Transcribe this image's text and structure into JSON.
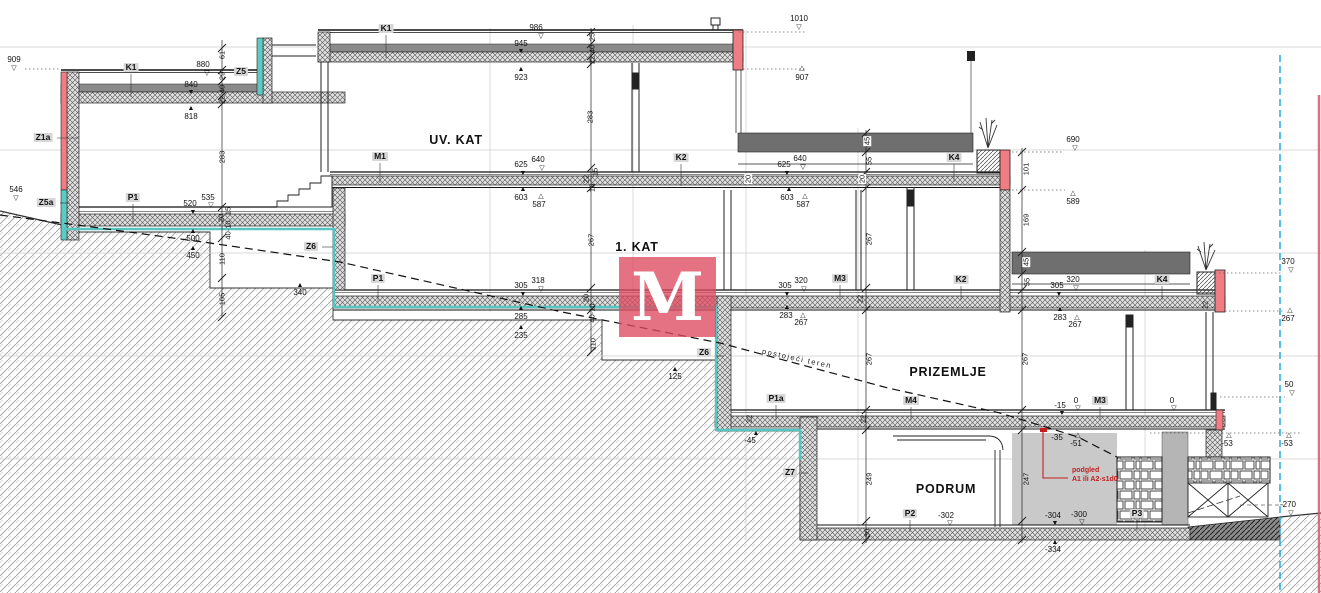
{
  "drawing": {
    "type": "building cross-section",
    "floor_names": [
      "UV. KAT",
      "1. KAT",
      "PRIZEMLJE",
      "PODRUM"
    ],
    "terrain_line_label": "postojeći teren",
    "note": {
      "line1": "podgled",
      "line2": "A1 ili A2-s1d0"
    },
    "colors": {
      "wall_accent_red": "#e2506a",
      "waterproofing_teal": "#56c4c0",
      "boundary_blue": "#2aa8dc",
      "deck_gray": "#6f6f6f",
      "watermark_red": "rgba(222,74,95,0.78)"
    }
  },
  "watermark": {
    "letter": "M"
  },
  "annotations": [
    {
      "t": "909",
      "x": 14,
      "y": 56,
      "c": "e",
      "n": "elev-909"
    },
    {
      "t": "▽",
      "x": 14,
      "y": 65,
      "c": "tri",
      "n": "marker-909"
    },
    {
      "t": "546",
      "x": 16,
      "y": 186,
      "c": "e",
      "n": "elev-546"
    },
    {
      "t": "▽",
      "x": 16,
      "y": 195,
      "c": "tri",
      "n": "marker-546"
    },
    {
      "t": "880",
      "x": 203,
      "y": 61,
      "c": "e",
      "n": "elev-880"
    },
    {
      "t": "▽",
      "x": 207,
      "y": 70,
      "c": "tri",
      "n": "marker-880"
    },
    {
      "t": "840",
      "x": 191,
      "y": 81,
      "c": "e",
      "n": "elev-840"
    },
    {
      "t": "▼",
      "x": 191,
      "y": 89,
      "c": "tri",
      "n": "marker-840"
    },
    {
      "t": "818",
      "x": 191,
      "y": 113,
      "c": "e",
      "n": "elev-818"
    },
    {
      "t": "▲",
      "x": 191,
      "y": 105,
      "c": "tri",
      "n": "marker-818"
    },
    {
      "t": "986",
      "x": 536,
      "y": 24,
      "c": "e",
      "n": "elev-986"
    },
    {
      "t": "▽",
      "x": 541,
      "y": 33,
      "c": "tri",
      "n": "marker-986"
    },
    {
      "t": "945",
      "x": 521,
      "y": 40,
      "c": "e",
      "n": "elev-945"
    },
    {
      "t": "▼",
      "x": 521,
      "y": 48,
      "c": "tri",
      "n": "marker-945"
    },
    {
      "t": "923",
      "x": 521,
      "y": 74,
      "c": "e",
      "n": "elev-923"
    },
    {
      "t": "▲",
      "x": 521,
      "y": 66,
      "c": "tri",
      "n": "marker-923"
    },
    {
      "t": "1010",
      "x": 799,
      "y": 15,
      "c": "e",
      "n": "elev-1010"
    },
    {
      "t": "▽",
      "x": 799,
      "y": 24,
      "c": "tri",
      "n": "marker-1010"
    },
    {
      "t": "907",
      "x": 802,
      "y": 74,
      "c": "e",
      "n": "elev-907"
    },
    {
      "t": "△",
      "x": 802,
      "y": 65,
      "c": "tri",
      "n": "marker-907"
    },
    {
      "t": "535",
      "x": 208,
      "y": 194,
      "c": "e",
      "n": "elev-535"
    },
    {
      "t": "▽",
      "x": 211,
      "y": 202,
      "c": "tri",
      "n": "marker-535"
    },
    {
      "t": "520",
      "x": 190,
      "y": 200,
      "c": "e",
      "n": "elev-520"
    },
    {
      "t": "▼",
      "x": 193,
      "y": 209,
      "c": "tri",
      "n": "marker-520"
    },
    {
      "t": "500",
      "x": 193,
      "y": 235,
      "c": "e",
      "n": "elev-500"
    },
    {
      "t": "▲",
      "x": 193,
      "y": 228,
      "c": "tri",
      "n": "marker-500"
    },
    {
      "t": "450",
      "x": 193,
      "y": 252,
      "c": "e",
      "n": "elev-450"
    },
    {
      "t": "▲",
      "x": 193,
      "y": 245,
      "c": "tri",
      "n": "marker-450"
    },
    {
      "t": "340",
      "x": 300,
      "y": 289,
      "c": "e",
      "n": "elev-340"
    },
    {
      "t": "▲",
      "x": 300,
      "y": 282,
      "c": "tri",
      "n": "marker-340"
    },
    {
      "t": "640",
      "x": 538,
      "y": 156,
      "c": "e",
      "n": "elev-640-m1"
    },
    {
      "t": "▽",
      "x": 542,
      "y": 165,
      "c": "tri",
      "n": "marker-640-m1"
    },
    {
      "t": "625",
      "x": 521,
      "y": 161,
      "c": "e",
      "n": "elev-625-m1"
    },
    {
      "t": "▼",
      "x": 523,
      "y": 170,
      "c": "tri",
      "n": "marker-625-m1"
    },
    {
      "t": "603",
      "x": 521,
      "y": 194,
      "c": "e",
      "n": "elev-603-m1"
    },
    {
      "t": "▲",
      "x": 523,
      "y": 186,
      "c": "tri",
      "n": "marker-603-m1"
    },
    {
      "t": "587",
      "x": 539,
      "y": 201,
      "c": "e",
      "n": "elev-587-m1"
    },
    {
      "t": "△",
      "x": 541,
      "y": 193,
      "c": "tri",
      "n": "marker-587-m1"
    },
    {
      "t": "318",
      "x": 538,
      "y": 277,
      "c": "e",
      "n": "elev-318"
    },
    {
      "t": "▽",
      "x": 541,
      "y": 286,
      "c": "tri",
      "n": "marker-318"
    },
    {
      "t": "305",
      "x": 521,
      "y": 282,
      "c": "e",
      "n": "elev-305-p1"
    },
    {
      "t": "▼",
      "x": 523,
      "y": 291,
      "c": "tri",
      "n": "marker-305-p1"
    },
    {
      "t": "285",
      "x": 521,
      "y": 313,
      "c": "e",
      "n": "elev-285"
    },
    {
      "t": "▲",
      "x": 521,
      "y": 305,
      "c": "tri",
      "n": "marker-285"
    },
    {
      "t": "235",
      "x": 521,
      "y": 332,
      "c": "e",
      "n": "elev-235"
    },
    {
      "t": "▲",
      "x": 521,
      "y": 324,
      "c": "tri",
      "n": "marker-235"
    },
    {
      "t": "640",
      "x": 800,
      "y": 155,
      "c": "e",
      "n": "elev-640-k2"
    },
    {
      "t": "▽",
      "x": 803,
      "y": 164,
      "c": "tri",
      "n": "marker-640-k2"
    },
    {
      "t": "625",
      "x": 784,
      "y": 161,
      "c": "e",
      "n": "elev-625-k2"
    },
    {
      "t": "▼",
      "x": 787,
      "y": 170,
      "c": "tri",
      "n": "marker-625-k2"
    },
    {
      "t": "603",
      "x": 787,
      "y": 194,
      "c": "e",
      "n": "elev-603-k2"
    },
    {
      "t": "▲",
      "x": 789,
      "y": 186,
      "c": "tri",
      "n": "marker-603-k2"
    },
    {
      "t": "587",
      "x": 803,
      "y": 201,
      "c": "e",
      "n": "elev-587-k2"
    },
    {
      "t": "△",
      "x": 805,
      "y": 193,
      "c": "tri",
      "n": "marker-587-k2"
    },
    {
      "t": "320",
      "x": 801,
      "y": 277,
      "c": "e",
      "n": "elev-320-m3"
    },
    {
      "t": "▽",
      "x": 804,
      "y": 286,
      "c": "tri",
      "n": "marker-320-m3"
    },
    {
      "t": "305",
      "x": 785,
      "y": 282,
      "c": "e",
      "n": "elev-305-m3"
    },
    {
      "t": "▼",
      "x": 787,
      "y": 291,
      "c": "tri",
      "n": "marker-305-m3"
    },
    {
      "t": "283",
      "x": 786,
      "y": 312,
      "c": "e",
      "n": "elev-283-m3"
    },
    {
      "t": "▲",
      "x": 787,
      "y": 304,
      "c": "tri",
      "n": "marker-283-m3"
    },
    {
      "t": "267",
      "x": 801,
      "y": 319,
      "c": "e",
      "n": "elev-267-m3"
    },
    {
      "t": "△",
      "x": 803,
      "y": 312,
      "c": "tri",
      "n": "marker-267-m3"
    },
    {
      "t": "690",
      "x": 1073,
      "y": 136,
      "c": "e",
      "n": "elev-690"
    },
    {
      "t": "▽",
      "x": 1075,
      "y": 145,
      "c": "tri",
      "n": "marker-690"
    },
    {
      "t": "589",
      "x": 1073,
      "y": 198,
      "c": "e",
      "n": "elev-589"
    },
    {
      "t": "△",
      "x": 1073,
      "y": 190,
      "c": "tri",
      "n": "marker-589"
    },
    {
      "t": "320",
      "x": 1073,
      "y": 276,
      "c": "e",
      "n": "elev-320-k4"
    },
    {
      "t": "▽",
      "x": 1076,
      "y": 285,
      "c": "tri",
      "n": "marker-320-k4"
    },
    {
      "t": "305",
      "x": 1057,
      "y": 282,
      "c": "e",
      "n": "elev-305-k4"
    },
    {
      "t": "▼",
      "x": 1059,
      "y": 291,
      "c": "tri",
      "n": "marker-305-k4"
    },
    {
      "t": "283",
      "x": 1060,
      "y": 314,
      "c": "e",
      "n": "elev-283-k4"
    },
    {
      "t": "▲",
      "x": 1060,
      "y": 306,
      "c": "tri",
      "n": "marker-283-k4"
    },
    {
      "t": "267",
      "x": 1075,
      "y": 321,
      "c": "e",
      "n": "elev-267-k4"
    },
    {
      "t": "△",
      "x": 1077,
      "y": 314,
      "c": "tri",
      "n": "marker-267-k4"
    },
    {
      "t": "370",
      "x": 1288,
      "y": 258,
      "c": "e",
      "n": "elev-370"
    },
    {
      "t": "▽",
      "x": 1291,
      "y": 267,
      "c": "tri",
      "n": "marker-370"
    },
    {
      "t": "267",
      "x": 1288,
      "y": 315,
      "c": "e",
      "n": "elev-267-r"
    },
    {
      "t": "△",
      "x": 1290,
      "y": 307,
      "c": "tri",
      "n": "marker-267-r"
    },
    {
      "t": "50",
      "x": 1289,
      "y": 381,
      "c": "e",
      "n": "elev-50"
    },
    {
      "t": "▽",
      "x": 1292,
      "y": 390,
      "c": "tri",
      "n": "marker-50"
    },
    {
      "t": "-53",
      "x": 1227,
      "y": 440,
      "c": "e",
      "n": "elev-53a"
    },
    {
      "t": "△",
      "x": 1229,
      "y": 432,
      "c": "tri",
      "n": "marker-53a"
    },
    {
      "t": "-53",
      "x": 1287,
      "y": 440,
      "c": "e",
      "n": "elev-53b"
    },
    {
      "t": "△",
      "x": 1289,
      "y": 432,
      "c": "tri",
      "n": "marker-53b"
    },
    {
      "t": "-270",
      "x": 1288,
      "y": 501,
      "c": "e",
      "n": "elev-270"
    },
    {
      "t": "▽",
      "x": 1291,
      "y": 510,
      "c": "tri",
      "n": "marker-270"
    },
    {
      "t": "125",
      "x": 675,
      "y": 373,
      "c": "e",
      "n": "elev-125"
    },
    {
      "t": "▲",
      "x": 675,
      "y": 366,
      "c": "tri",
      "n": "marker-125"
    },
    {
      "t": "-45",
      "x": 750,
      "y": 437,
      "c": "e",
      "n": "elev-45"
    },
    {
      "t": "▲",
      "x": 756,
      "y": 430,
      "c": "tri",
      "n": "marker-45"
    },
    {
      "t": "-15",
      "x": 1060,
      "y": 402,
      "c": "e",
      "n": "elev-15"
    },
    {
      "t": "▼",
      "x": 1062,
      "y": 410,
      "c": "tri",
      "n": "marker-15"
    },
    {
      "t": "0",
      "x": 1076,
      "y": 397,
      "c": "e",
      "n": "elev-0a"
    },
    {
      "t": "▽",
      "x": 1078,
      "y": 405,
      "c": "tri",
      "n": "marker-0a"
    },
    {
      "t": "0",
      "x": 1172,
      "y": 397,
      "c": "e",
      "n": "elev-0b"
    },
    {
      "t": "▽",
      "x": 1174,
      "y": 405,
      "c": "tri",
      "n": "marker-0b"
    },
    {
      "t": "-35",
      "x": 1057,
      "y": 434,
      "c": "e",
      "n": "elev-35"
    },
    {
      "t": "-51",
      "x": 1076,
      "y": 440,
      "c": "e",
      "n": "elev-51"
    },
    {
      "t": "△",
      "x": 1078,
      "y": 432,
      "c": "tri",
      "n": "marker-51"
    },
    {
      "t": "-302",
      "x": 946,
      "y": 512,
      "c": "e",
      "n": "elev-302"
    },
    {
      "t": "▽",
      "x": 950,
      "y": 520,
      "c": "tri",
      "n": "marker-302"
    },
    {
      "t": "-304",
      "x": 1053,
      "y": 512,
      "c": "e",
      "n": "elev-304"
    },
    {
      "t": "▼",
      "x": 1055,
      "y": 520,
      "c": "tri",
      "n": "marker-304"
    },
    {
      "t": "-300",
      "x": 1079,
      "y": 511,
      "c": "e",
      "n": "elev-300"
    },
    {
      "t": "▽",
      "x": 1082,
      "y": 519,
      "c": "tri",
      "n": "marker-300"
    },
    {
      "t": "-334",
      "x": 1053,
      "y": 546,
      "c": "e",
      "n": "elev-334"
    },
    {
      "t": "▲",
      "x": 1055,
      "y": 539,
      "c": "tri",
      "n": "marker-334"
    },
    {
      "t": "Z1a",
      "x": 43,
      "y": 133,
      "c": "tag",
      "n": "tag-z1a"
    },
    {
      "t": "Z5a",
      "x": 46,
      "y": 198,
      "c": "tag",
      "n": "tag-z5a"
    },
    {
      "t": "K1",
      "x": 131,
      "y": 63,
      "c": "tag",
      "n": "tag-k1-left"
    },
    {
      "t": "Z5",
      "x": 241,
      "y": 67,
      "c": "tag",
      "n": "tag-z5"
    },
    {
      "t": "K1",
      "x": 386,
      "y": 24,
      "c": "tag",
      "n": "tag-k1-main"
    },
    {
      "t": "M1",
      "x": 380,
      "y": 152,
      "c": "tag",
      "n": "tag-m1"
    },
    {
      "t": "P1",
      "x": 133,
      "y": 193,
      "c": "tag",
      "n": "tag-p1-left"
    },
    {
      "t": "P1",
      "x": 378,
      "y": 274,
      "c": "tag",
      "n": "tag-p1-main"
    },
    {
      "t": "Z6",
      "x": 311,
      "y": 242,
      "c": "tag",
      "n": "tag-z6-left"
    },
    {
      "t": "Z6",
      "x": 704,
      "y": 348,
      "c": "tag",
      "n": "tag-z6-mid"
    },
    {
      "t": "K2",
      "x": 681,
      "y": 153,
      "c": "tag",
      "n": "tag-k2-top"
    },
    {
      "t": "K2",
      "x": 961,
      "y": 275,
      "c": "tag",
      "n": "tag-k2-right"
    },
    {
      "t": "K4",
      "x": 954,
      "y": 153,
      "c": "tag",
      "n": "tag-k4-top"
    },
    {
      "t": "K4",
      "x": 1162,
      "y": 275,
      "c": "tag",
      "n": "tag-k4-low"
    },
    {
      "t": "M3",
      "x": 840,
      "y": 274,
      "c": "tag",
      "n": "tag-m3-up"
    },
    {
      "t": "M3",
      "x": 1100,
      "y": 396,
      "c": "tag",
      "n": "tag-m3-low"
    },
    {
      "t": "M4",
      "x": 911,
      "y": 396,
      "c": "t ag",
      "n": "tag-m4"
    },
    {
      "t": "P1a",
      "x": 776,
      "y": 394,
      "c": "tag",
      "n": "tag-p1a"
    },
    {
      "t": "Z7",
      "x": 790,
      "y": 468,
      "c": "tag",
      "n": "tag-z7"
    },
    {
      "t": "P2",
      "x": 910,
      "y": 509,
      "c": "tag",
      "n": "tag-p2"
    },
    {
      "t": "P3",
      "x": 1137,
      "y": 509,
      "c": "tag",
      "n": "tag-p3"
    },
    {
      "t": "UV.  KAT",
      "x": 456,
      "y": 134,
      "c": "flr",
      "n": "floor-uv-kat"
    },
    {
      "t": "1.  KAT",
      "x": 637,
      "y": 241,
      "c": "flr",
      "n": "floor-1-kat"
    },
    {
      "t": "PRIZEMLJE",
      "x": 948,
      "y": 366,
      "c": "flr",
      "n": "floor-prizemlje"
    },
    {
      "t": "PODRUM",
      "x": 946,
      "y": 483,
      "c": "flr",
      "n": "floor-podrum"
    },
    {
      "t": "61",
      "x": 222,
      "y": 55,
      "c": "d",
      "n": "dim-61"
    },
    {
      "t": "29",
      "x": 222,
      "y": 76,
      "c": "d",
      "n": "dim-29"
    },
    {
      "t": "40",
      "x": 222,
      "y": 89,
      "c": "d",
      "n": "dim-40a"
    },
    {
      "t": "22",
      "x": 222,
      "y": 100,
      "c": "d",
      "n": "dim-22a"
    },
    {
      "t": "283",
      "x": 222,
      "y": 157,
      "c": "d",
      "n": "dim-283a"
    },
    {
      "t": "15",
      "x": 228,
      "y": 211,
      "c": "d",
      "n": "dim-15a"
    },
    {
      "t": "20",
      "x": 221,
      "y": 218,
      "c": "d",
      "n": "dim-20a"
    },
    {
      "t": "40·10",
      "x": 228,
      "y": 230,
      "c": "d",
      "n": "dim-4010a"
    },
    {
      "t": "110",
      "x": 222,
      "y": 259,
      "c": "d",
      "n": "dim-110a"
    },
    {
      "t": "105",
      "x": 222,
      "y": 299,
      "c": "d",
      "n": "dim-105"
    },
    {
      "t": "25",
      "x": 592,
      "y": 37,
      "c": "d",
      "n": "dim-25"
    },
    {
      "t": "40",
      "x": 592,
      "y": 49,
      "c": "d",
      "n": "dim-40b"
    },
    {
      "t": "22",
      "x": 592,
      "y": 60,
      "c": "d",
      "n": "dim-22b"
    },
    {
      "t": "283",
      "x": 590,
      "y": 117,
      "c": "d",
      "n": "dim-283b"
    },
    {
      "t": "15",
      "x": 595,
      "y": 172,
      "c": "d",
      "n": "dim-15b"
    },
    {
      "t": "22",
      "x": 586,
      "y": 179,
      "c": "d",
      "n": "dim-22c"
    },
    {
      "t": "16",
      "x": 592,
      "y": 188,
      "c": "d",
      "n": "dim-16a"
    },
    {
      "t": "267",
      "x": 591,
      "y": 240,
      "c": "d",
      "n": "dim-267a"
    },
    {
      "t": "20",
      "x": 586,
      "y": 298,
      "c": "d",
      "n": "dim-20b"
    },
    {
      "t": "40·10",
      "x": 592,
      "y": 313,
      "c": "d",
      "n": "dim-4010b"
    },
    {
      "t": "110",
      "x": 593,
      "y": 344,
      "c": "d",
      "n": "dim-110b"
    },
    {
      "t": "45",
      "x": 867,
      "y": 141,
      "c": "dw",
      "n": "dim-45-up"
    },
    {
      "t": "55",
      "x": 869,
      "y": 161,
      "c": "d",
      "n": "dim-55-up"
    },
    {
      "t": "20",
      "x": 862,
      "y": 179,
      "c": "dw",
      "n": "dim-20-up"
    },
    {
      "t": "267",
      "x": 869,
      "y": 239,
      "c": "d",
      "n": "dim-267b"
    },
    {
      "t": "22",
      "x": 860,
      "y": 299,
      "c": "d",
      "n": "dim-22d"
    },
    {
      "t": "267",
      "x": 869,
      "y": 359,
      "c": "d",
      "n": "dim-267c"
    },
    {
      "t": "22",
      "x": 863,
      "y": 419,
      "c": "d",
      "n": "dim-22e"
    },
    {
      "t": "249",
      "x": 869,
      "y": 479,
      "c": "d",
      "n": "dim-249"
    },
    {
      "t": "30",
      "x": 867,
      "y": 533,
      "c": "d",
      "n": "dim-30"
    },
    {
      "t": "101",
      "x": 1026,
      "y": 169,
      "c": "d",
      "n": "dim-101"
    },
    {
      "t": "169",
      "x": 1026,
      "y": 220,
      "c": "d",
      "n": "dim-169"
    },
    {
      "t": "45",
      "x": 1026,
      "y": 262,
      "c": "dw",
      "n": "dim-45-low"
    },
    {
      "t": "55",
      "x": 1027,
      "y": 282,
      "c": "d",
      "n": "dim-55-low"
    },
    {
      "t": "267",
      "x": 1025,
      "y": 359,
      "c": "d",
      "n": "dim-267d"
    },
    {
      "t": "247",
      "x": 1026,
      "y": 479,
      "c": "d",
      "n": "dim-247"
    },
    {
      "t": "20",
      "x": 748,
      "y": 179,
      "c": "dw",
      "n": "dim-20-c"
    },
    {
      "t": "22",
      "x": 749,
      "y": 419,
      "c": "d",
      "n": "dim-22f"
    },
    {
      "t": "22",
      "x": 1205,
      "y": 305,
      "c": "d",
      "n": "dim-22g"
    },
    {
      "t": "podgled",
      "x": 1072,
      "y": 467,
      "c": "red",
      "n": "note-podgled"
    },
    {
      "t": "A1 ili A2-s1d0",
      "x": 1072,
      "y": 476,
      "c": "red",
      "n": "note-a1-a2"
    },
    {
      "t": "postojeći teren",
      "x": 797,
      "y": 355,
      "c": "ter",
      "n": "terrain-line-label"
    }
  ]
}
